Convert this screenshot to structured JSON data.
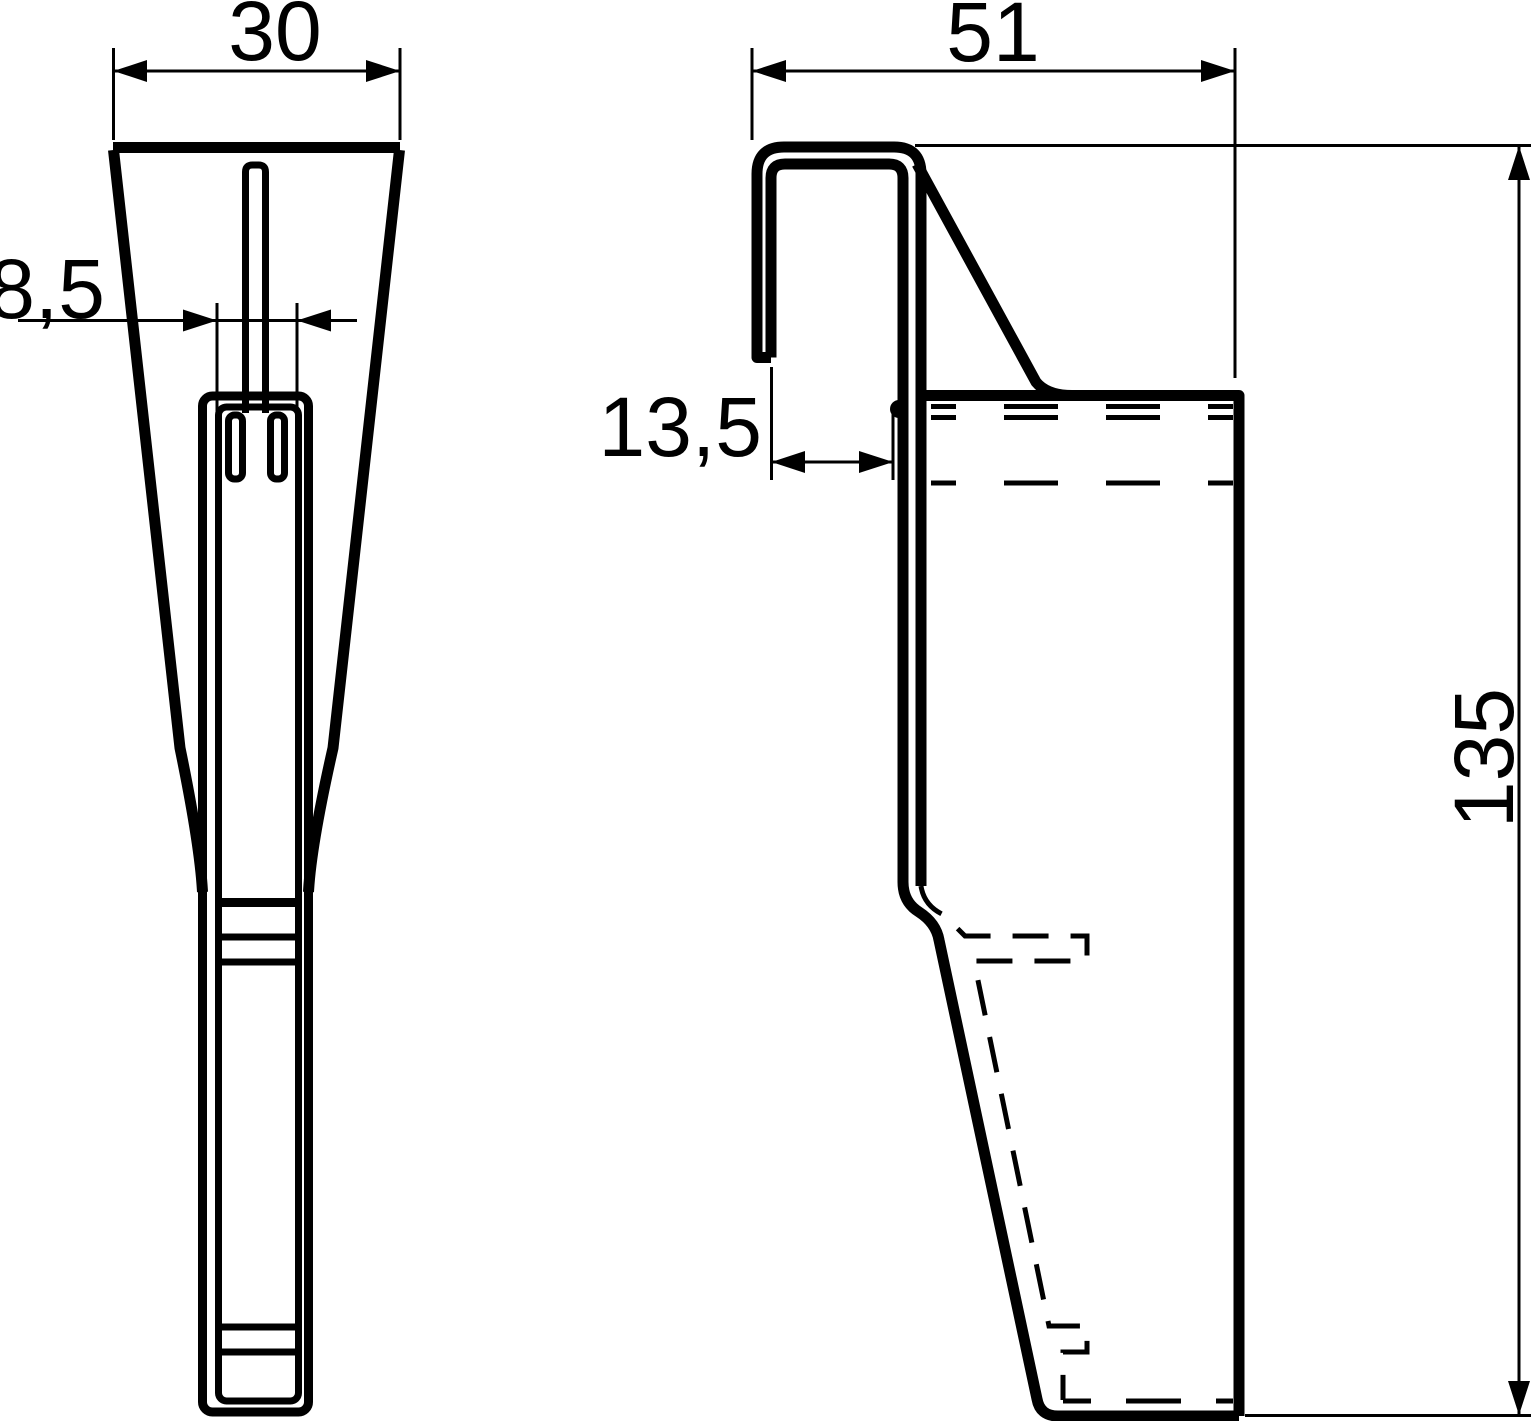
{
  "drawing": {
    "kind": "technical-drawing",
    "background_color": "#ffffff",
    "line_color": "#000000",
    "views": {
      "front_view": {
        "dimensions": {
          "top_width": "30",
          "slot_width": "8,5"
        }
      },
      "side_view": {
        "dimensions": {
          "depth": "51",
          "hook_opening_depth": "13,5",
          "height": "135"
        }
      }
    }
  }
}
